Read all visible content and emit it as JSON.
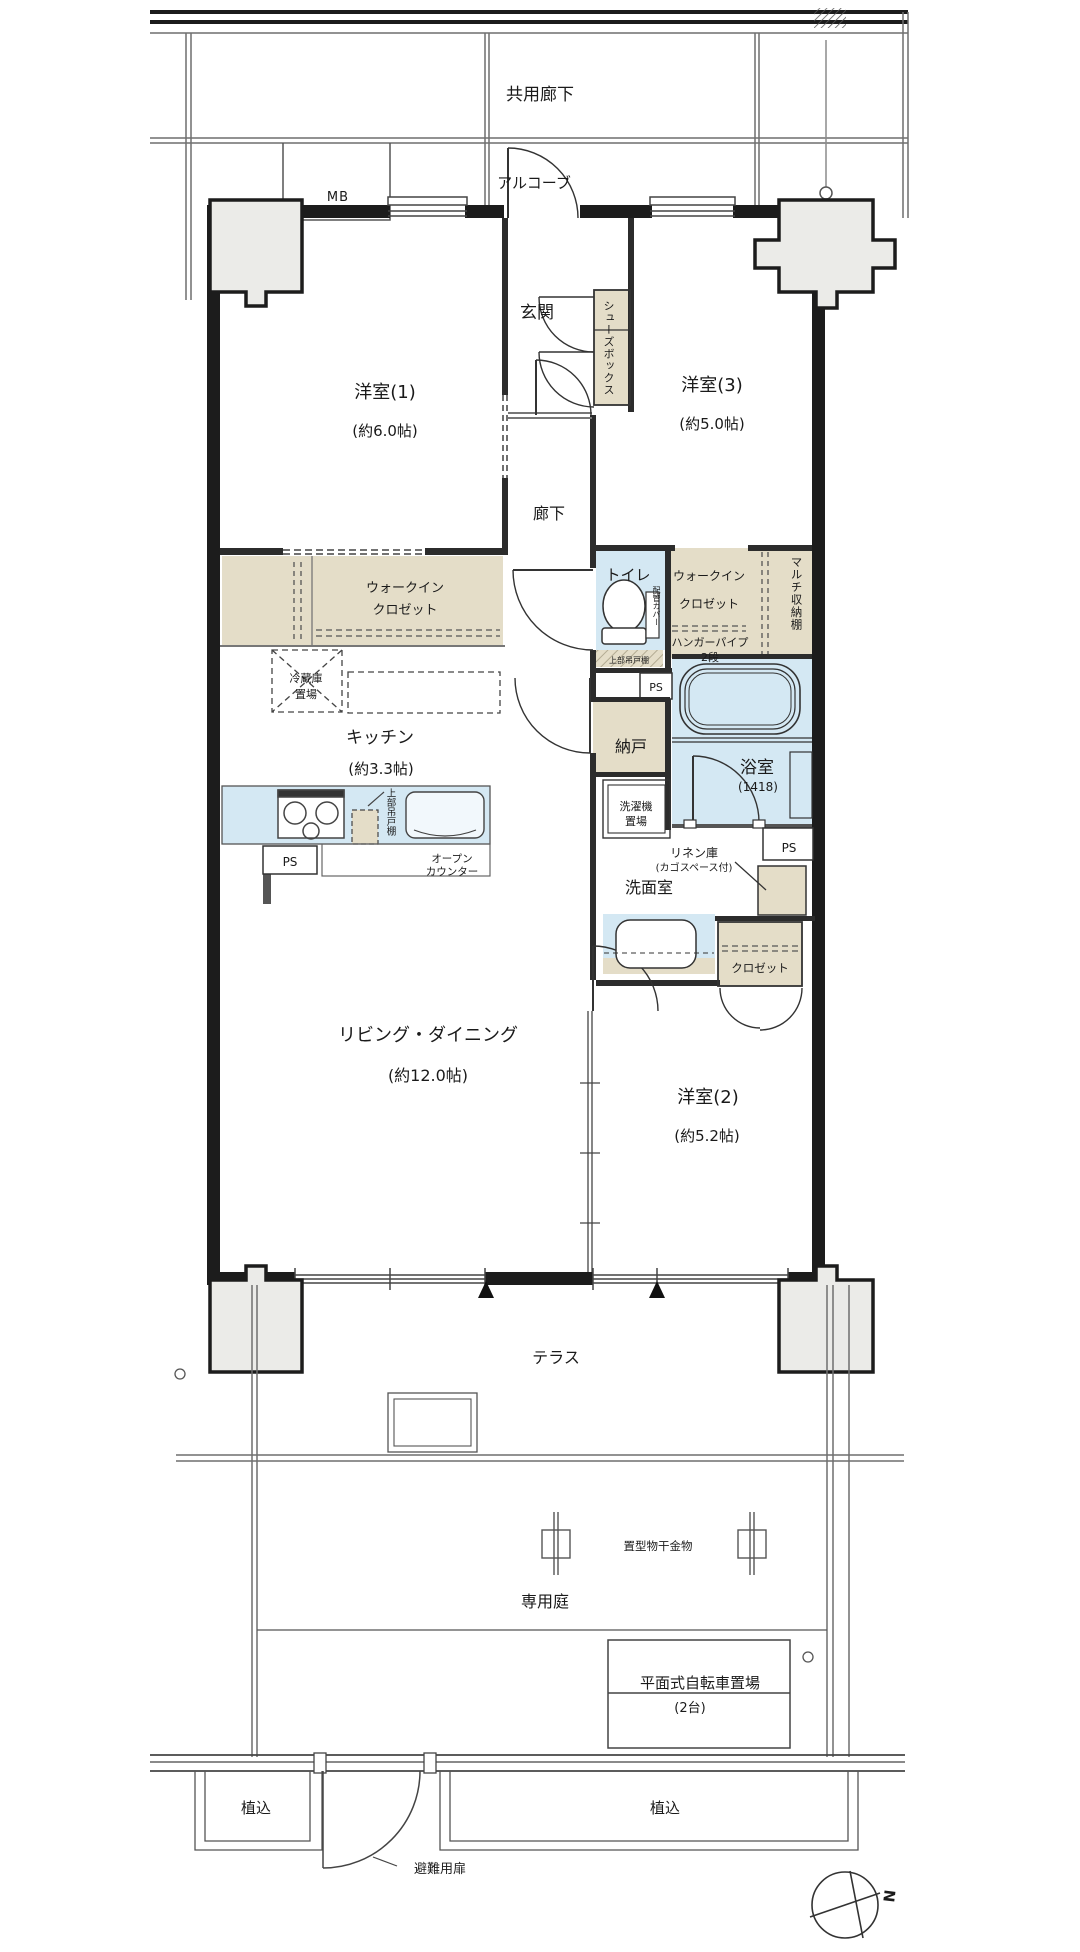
{
  "colors": {
    "wall": "#1c1c1c",
    "closet_beige": "#e4ddc8",
    "wet_blue": "#d4e8f3",
    "pillar_gray": "#ebebe8",
    "thin_line": "#8b8b8b"
  },
  "labels": {
    "common_corridor": "共用廊下",
    "alcove": "アルコーブ",
    "mb": "MB",
    "entrance": "玄関",
    "shoes_box": "シューズボックス",
    "room1": "洋室(1)",
    "room1_size": "(約6.0帖)",
    "room3": "洋室(3)",
    "room3_size": "(約5.0帖)",
    "hallway": "廊下",
    "wic1_line1": "ウォークイン",
    "wic1_line2": "クロゼット",
    "toilet": "トイレ",
    "pipe_cover": "配管カバー",
    "toilet_upper_cabinet": "上部吊戸棚",
    "wic2_line1": "ウォークイン",
    "wic2_line2": "クロゼット",
    "hanger_pipe_line1": "ハンガーパイプ",
    "hanger_pipe_line2": "2段",
    "multi_storage": "マルチ収納棚",
    "fridge_line1": "冷蔵庫",
    "fridge_line2": "置場",
    "kitchen": "キッチン",
    "kitchen_size": "(約3.3帖)",
    "storeroom": "納戸",
    "ps": "PS",
    "bath": "浴室",
    "bath_size": "(1418)",
    "washer_line1": "洗濯機",
    "washer_line2": "置場",
    "kitchen_upper_cabinet": "上部吊戸棚",
    "open_counter_line1": "オープン",
    "open_counter_line2": "カウンター",
    "linen_line1": "リネン庫",
    "linen_line2": "(カゴスペース付)",
    "washroom": "洗面室",
    "closet2": "クロゼット",
    "living": "リビング・ダイニング",
    "living_size": "(約12.0帖)",
    "room2": "洋室(2)",
    "room2_size": "(約5.2帖)",
    "terrace": "テラス",
    "laundry_fitting": "置型物干金物",
    "private_garden": "専用庭",
    "bicycle_line1": "平面式自転車置場",
    "bicycle_line2": "(2台)",
    "planting_left": "植込",
    "planting_right": "植込",
    "evacuation_door": "避難用扉",
    "compass_north": "N"
  }
}
